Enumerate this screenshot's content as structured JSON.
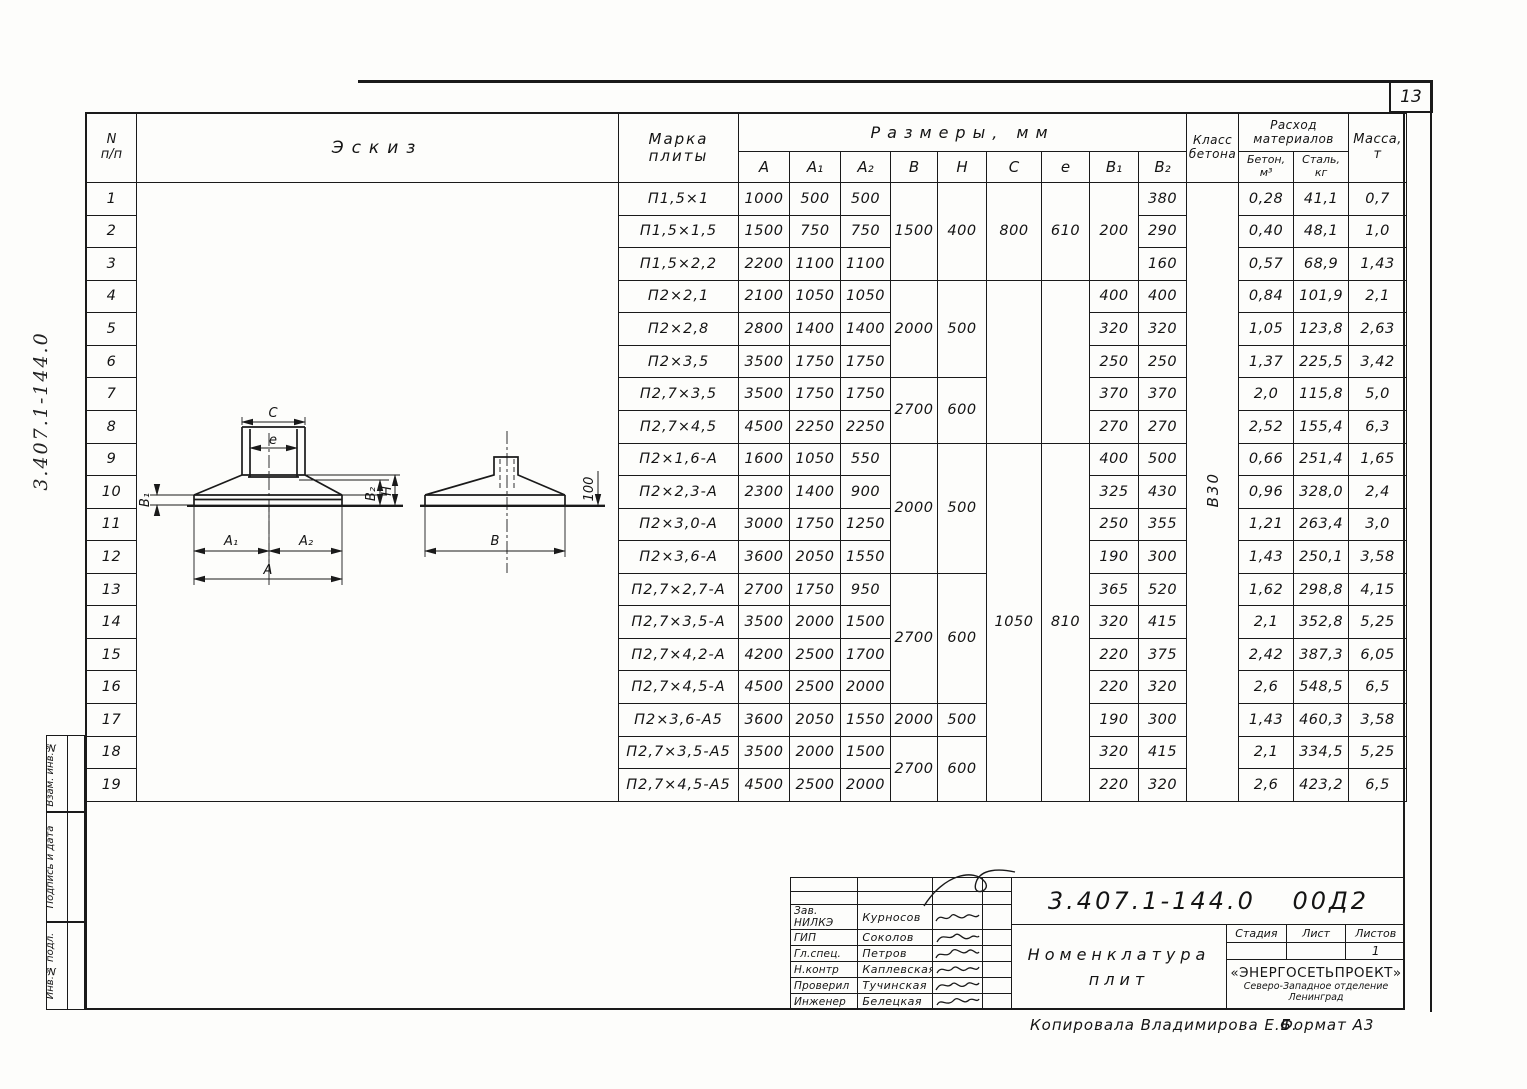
{
  "page": {
    "number": "13",
    "side_doc_number": "3.407.1-144.0"
  },
  "margin_labels": [
    "Взам. инв.№",
    "Подпись и дата",
    "Инв.№ подл."
  ],
  "footer": {
    "copied": "Копировала Владимирова Е.Б.",
    "format": "Формат А3"
  },
  "sketch": {
    "c": "С",
    "e": "е",
    "b1": "В₁",
    "b2": "В₂",
    "h": "Н",
    "a1": "А₁",
    "a2": "А₂",
    "a": "А",
    "b": "В",
    "edge_dim": "100"
  },
  "table": {
    "headers": {
      "n": [
        "N",
        "п/п"
      ],
      "eskiz": "Эскиз",
      "marka": [
        "Марка",
        "плиты"
      ],
      "razmery": "Размеры, мм",
      "dims": [
        "А",
        "А₁",
        "А₂",
        "В",
        "Н",
        "С",
        "е",
        "В₁",
        "В₂"
      ],
      "klass": [
        "Класс",
        "бетона"
      ],
      "rashod": [
        "Расход",
        "материалов"
      ],
      "beton": [
        "Бетон,",
        "м³"
      ],
      "stal": [
        "Сталь,",
        "кг"
      ],
      "massa": [
        "Масса,",
        "т"
      ]
    },
    "concrete_class": "В30",
    "rows": [
      {
        "n": "1",
        "mark": "П1,5×1",
        "a": "1000",
        "a1": "500",
        "a2": "500",
        "b1": "",
        "b2": "380",
        "beton": "0,28",
        "stal": "41,1",
        "massa": "0,7"
      },
      {
        "n": "2",
        "mark": "П1,5×1,5",
        "a": "1500",
        "a1": "750",
        "a2": "750",
        "b1": "",
        "b2": "290",
        "beton": "0,40",
        "stal": "48,1",
        "massa": "1,0"
      },
      {
        "n": "3",
        "mark": "П1,5×2,2",
        "a": "2200",
        "a1": "1100",
        "a2": "1100",
        "b1": "",
        "b2": "160",
        "beton": "0,57",
        "stal": "68,9",
        "massa": "1,43"
      },
      {
        "n": "4",
        "mark": "П2×2,1",
        "a": "2100",
        "a1": "1050",
        "a2": "1050",
        "b1": "400",
        "b2": "400",
        "beton": "0,84",
        "stal": "101,9",
        "massa": "2,1"
      },
      {
        "n": "5",
        "mark": "П2×2,8",
        "a": "2800",
        "a1": "1400",
        "a2": "1400",
        "b1": "320",
        "b2": "320",
        "beton": "1,05",
        "stal": "123,8",
        "massa": "2,63"
      },
      {
        "n": "6",
        "mark": "П2×3,5",
        "a": "3500",
        "a1": "1750",
        "a2": "1750",
        "b1": "250",
        "b2": "250",
        "beton": "1,37",
        "stal": "225,5",
        "massa": "3,42"
      },
      {
        "n": "7",
        "mark": "П2,7×3,5",
        "a": "3500",
        "a1": "1750",
        "a2": "1750",
        "b1": "370",
        "b2": "370",
        "beton": "2,0",
        "stal": "115,8",
        "massa": "5,0"
      },
      {
        "n": "8",
        "mark": "П2,7×4,5",
        "a": "4500",
        "a1": "2250",
        "a2": "2250",
        "b1": "270",
        "b2": "270",
        "beton": "2,52",
        "stal": "155,4",
        "massa": "6,3"
      },
      {
        "n": "9",
        "mark": "П2×1,6-А",
        "a": "1600",
        "a1": "1050",
        "a2": "550",
        "b1": "400",
        "b2": "500",
        "beton": "0,66",
        "stal": "251,4",
        "massa": "1,65"
      },
      {
        "n": "10",
        "mark": "П2×2,3-А",
        "a": "2300",
        "a1": "1400",
        "a2": "900",
        "b1": "325",
        "b2": "430",
        "beton": "0,96",
        "stal": "328,0",
        "massa": "2,4"
      },
      {
        "n": "11",
        "mark": "П2×3,0-А",
        "a": "3000",
        "a1": "1750",
        "a2": "1250",
        "b1": "250",
        "b2": "355",
        "beton": "1,21",
        "stal": "263,4",
        "massa": "3,0"
      },
      {
        "n": "12",
        "mark": "П2×3,6-А",
        "a": "3600",
        "a1": "2050",
        "a2": "1550",
        "b1": "190",
        "b2": "300",
        "beton": "1,43",
        "stal": "250,1",
        "massa": "3,58"
      },
      {
        "n": "13",
        "mark": "П2,7×2,7-А",
        "a": "2700",
        "a1": "1750",
        "a2": "950",
        "b1": "365",
        "b2": "520",
        "beton": "1,62",
        "stal": "298,8",
        "massa": "4,15"
      },
      {
        "n": "14",
        "mark": "П2,7×3,5-А",
        "a": "3500",
        "a1": "2000",
        "a2": "1500",
        "b1": "320",
        "b2": "415",
        "beton": "2,1",
        "stal": "352,8",
        "massa": "5,25"
      },
      {
        "n": "15",
        "mark": "П2,7×4,2-А",
        "a": "4200",
        "a1": "2500",
        "a2": "1700",
        "b1": "220",
        "b2": "375",
        "beton": "2,42",
        "stal": "387,3",
        "massa": "6,05"
      },
      {
        "n": "16",
        "mark": "П2,7×4,5-А",
        "a": "4500",
        "a1": "2500",
        "a2": "2000",
        "b1": "220",
        "b2": "320",
        "beton": "2,6",
        "stal": "548,5",
        "massa": "6,5"
      },
      {
        "n": "17",
        "mark": "П2×3,6-А5",
        "a": "3600",
        "a1": "2050",
        "a2": "1550",
        "b1": "190",
        "b2": "300",
        "beton": "1,43",
        "stal": "460,3",
        "massa": "3,58"
      },
      {
        "n": "18",
        "mark": "П2,7×3,5-А5",
        "a": "3500",
        "a1": "2000",
        "a2": "1500",
        "b1": "320",
        "b2": "415",
        "beton": "2,1",
        "stal": "334,5",
        "massa": "5,25"
      },
      {
        "n": "19",
        "mark": "П2,7×4,5-А5",
        "a": "4500",
        "a1": "2500",
        "a2": "2000",
        "b1": "220",
        "b2": "320",
        "beton": "2,6",
        "stal": "423,2",
        "massa": "6,5"
      }
    ],
    "merges": {
      "b_h": [
        {
          "from": 1,
          "to": 3,
          "b": "1500",
          "h": "400"
        },
        {
          "from": 4,
          "to": 6,
          "b": "2000",
          "h": "500"
        },
        {
          "from": 7,
          "to": 8,
          "b": "2700",
          "h": "600"
        },
        {
          "from": 9,
          "to": 12,
          "b": "2000",
          "h": "500"
        },
        {
          "from": 13,
          "to": 16,
          "b": "2700",
          "h": "600"
        },
        {
          "from": 17,
          "to": 17,
          "b": "2000",
          "h": "500"
        },
        {
          "from": 18,
          "to": 19,
          "b": "2700",
          "h": "600"
        }
      ],
      "c_e": [
        {
          "from": 1,
          "to": 3,
          "c": "800",
          "e": "610"
        },
        {
          "from": 4,
          "to": 8,
          "c": "",
          "e": ""
        },
        {
          "from": 9,
          "to": 19,
          "c": "1050",
          "e": "810",
          "align": "top"
        }
      ],
      "b1": [
        {
          "from": 1,
          "to": 3,
          "v": "200"
        }
      ]
    }
  },
  "title_block": {
    "doc_number": "3.407.1-144.0 00Д2",
    "title_lines": [
      "Номенклатура",
      "плит"
    ],
    "signatures": [
      {
        "role": "Зав. НИЛКЭ",
        "name": "Курносов"
      },
      {
        "role": "ГИП",
        "name": "Соколов"
      },
      {
        "role": "Гл.спец.",
        "name": "Петров"
      },
      {
        "role": "Н.контр",
        "name": "Каплевская"
      },
      {
        "role": "Проверил",
        "name": "Тучинская"
      },
      {
        "role": "Инженер",
        "name": "Белецкая"
      }
    ],
    "stage_labels": [
      "Стадия",
      "Лист",
      "Листов"
    ],
    "stage_values": [
      "",
      "",
      "1"
    ],
    "org_lines": [
      "«ЭНЕРГОСЕТЬПРОЕКТ»",
      "Северо-Западное отделение",
      "Ленинград"
    ]
  }
}
